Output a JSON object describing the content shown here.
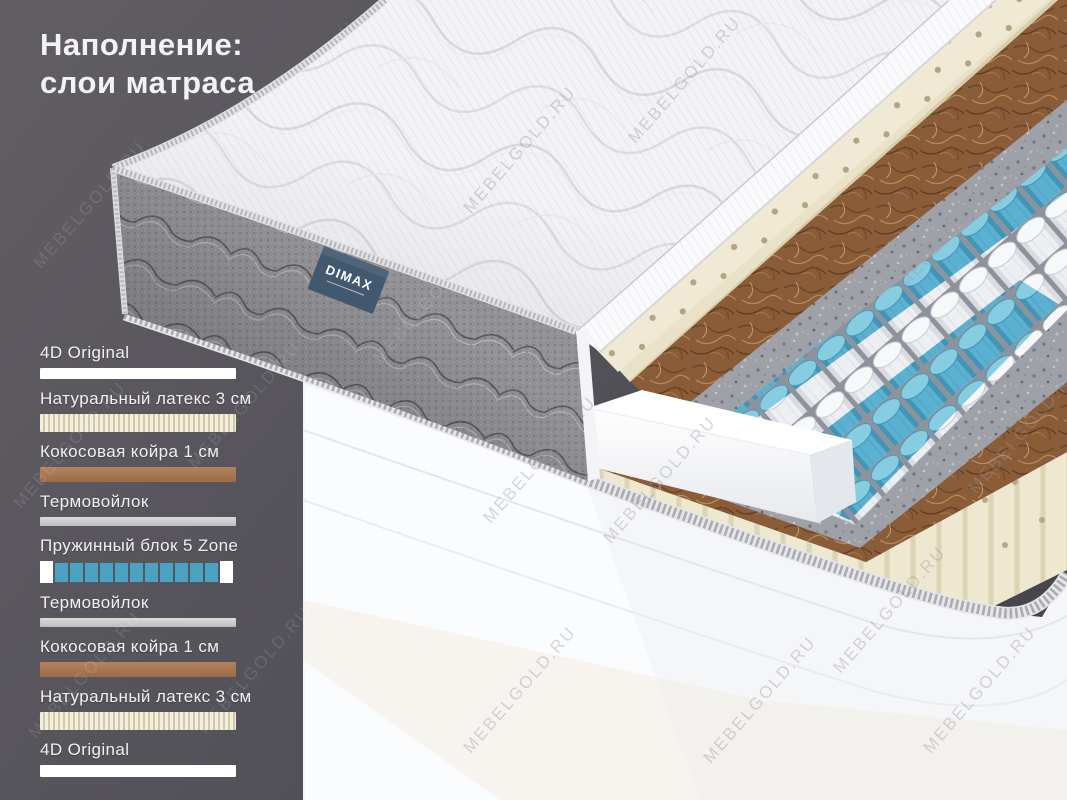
{
  "title": {
    "line1": "Наполнение:",
    "line2": "слои матраса"
  },
  "brand": {
    "label": "DIMAX"
  },
  "watermark": {
    "text": "MEBELGOLD.RU"
  },
  "colors": {
    "accent_blue": "#4ba3c3",
    "coir_brown": "#a9795a",
    "latex_cream": "#f2ecd8",
    "felt_gray": "#c9c9c9",
    "cover_white": "#ffffff",
    "background_dark": "#56545a",
    "tag_blue": "#42586e"
  },
  "legend": {
    "layers": [
      {
        "label": "4D Original",
        "type": "cover"
      },
      {
        "label": "Натуральный латекс 3 см",
        "type": "latex"
      },
      {
        "label": "Кокосовая койра 1 см",
        "type": "coir"
      },
      {
        "label": "Термовойлок",
        "type": "felt"
      },
      {
        "label": "Пружинный блок 5 Zone",
        "type": "springs",
        "squares": [
          "white",
          "blue",
          "blue",
          "blue",
          "blue",
          "blue",
          "blue",
          "blue",
          "blue",
          "blue",
          "blue",
          "blue",
          "white"
        ]
      },
      {
        "label": "Термовойлок",
        "type": "felt"
      },
      {
        "label": "Кокосовая койра 1 см",
        "type": "coir"
      },
      {
        "label": "Натуральный латекс 3 см",
        "type": "latex"
      },
      {
        "label": "4D Original",
        "type": "cover2"
      }
    ]
  }
}
